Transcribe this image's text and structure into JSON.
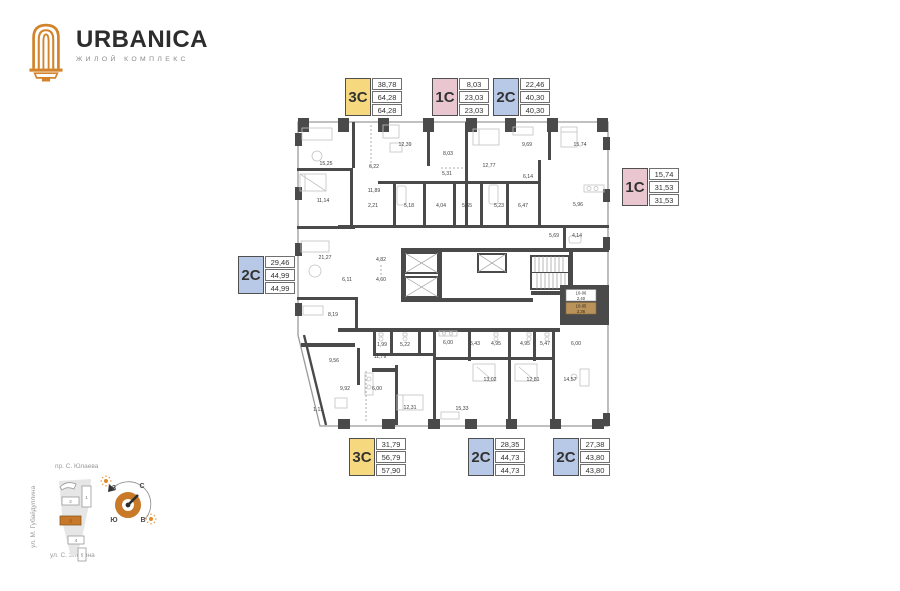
{
  "brand": {
    "name": "URBANICA",
    "tagline": "ЖИЛОЙ КОМПЛЕКС"
  },
  "colors": {
    "accent_orange": "#d2832b",
    "type_yellow": "#f6d87e",
    "type_pink": "#eac6d0",
    "type_blue": "#b7c9e6",
    "wall_dark": "#4a4a4a",
    "highlight_tan": "#b9935a"
  },
  "cards": [
    {
      "type": "3C",
      "color": "yellow",
      "values": [
        "38,78",
        "64,28",
        "64,28"
      ]
    },
    {
      "type": "1C",
      "color": "pink",
      "values": [
        "8,03",
        "23,03",
        "23,03"
      ]
    },
    {
      "type": "2C",
      "color": "blue",
      "values": [
        "22,46",
        "40,30",
        "40,30"
      ]
    },
    {
      "type": "1C",
      "color": "pink",
      "values": [
        "15,74",
        "31,53",
        "31,53"
      ]
    },
    {
      "type": "2C",
      "color": "blue",
      "values": [
        "29,46",
        "44,99",
        "44,99"
      ]
    },
    {
      "type": "3C",
      "color": "yellow",
      "values": [
        "31,79",
        "56,79",
        "57,90"
      ]
    },
    {
      "type": "2C",
      "color": "blue",
      "values": [
        "28,35",
        "44,73",
        "44,73"
      ]
    },
    {
      "type": "2C",
      "color": "blue",
      "values": [
        "27,38",
        "43,80",
        "43,80"
      ]
    }
  ],
  "plan": {
    "rooms": [
      {
        "value": "15,25"
      },
      {
        "value": "12,39"
      },
      {
        "value": "6,22"
      },
      {
        "value": "8,03"
      },
      {
        "value": "5,31"
      },
      {
        "value": "12,77"
      },
      {
        "value": "9,69"
      },
      {
        "value": "15,74"
      },
      {
        "value": "6,14"
      },
      {
        "value": "11,14"
      },
      {
        "value": "11,89"
      },
      {
        "value": "2,21"
      },
      {
        "value": "5,18"
      },
      {
        "value": "4,04"
      },
      {
        "value": "5,65"
      },
      {
        "value": "5,23"
      },
      {
        "value": "6,47"
      },
      {
        "value": "5,96"
      },
      {
        "value": "5,69"
      },
      {
        "value": "4,14"
      },
      {
        "value": "21,27"
      },
      {
        "value": "4,82"
      },
      {
        "value": "6,11"
      },
      {
        "value": "4,60"
      },
      {
        "value": "8,19"
      },
      {
        "value": "1,99"
      },
      {
        "value": "5,22"
      },
      {
        "value": "6,00"
      },
      {
        "value": "9,56"
      },
      {
        "value": "11,79"
      },
      {
        "value": "9,92"
      },
      {
        "value": "6,00"
      },
      {
        "value": "1,11"
      },
      {
        "value": "12,31"
      },
      {
        "value": "5,43"
      },
      {
        "value": "4,95"
      },
      {
        "value": "4,95"
      },
      {
        "value": "5,47"
      },
      {
        "value": "6,00"
      },
      {
        "value": "13,02"
      },
      {
        "value": "12,81"
      },
      {
        "value": "14,57"
      },
      {
        "value": "15,33"
      }
    ],
    "unit_tags": [
      {
        "number": "10-06",
        "area": "2,40",
        "highlighted": false
      },
      {
        "number": "10-05",
        "area": "2,36",
        "highlighted": true
      }
    ]
  },
  "minimap": {
    "streets": {
      "top": "пр. С. Юлаева",
      "left": "ул. М. Губайдуллина",
      "bottom": "ул. С. Злобина"
    },
    "buildings": [
      "1",
      "2",
      "3",
      "4",
      "5"
    ],
    "active_building": "3",
    "compass": {
      "west": "З",
      "north": "С",
      "south": "Ю",
      "east": "В"
    }
  }
}
